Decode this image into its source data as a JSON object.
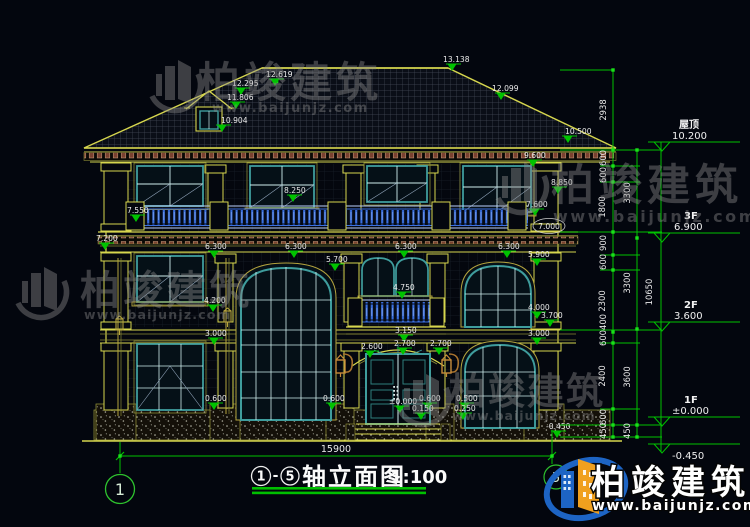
{
  "title": {
    "axis_from": "1",
    "sep": "-",
    "axis_to": "5",
    "name": "轴立面图",
    "scale": "1:100"
  },
  "bottom": {
    "width": "15900",
    "axis_left": "1",
    "axis_right": "5"
  },
  "levels": {
    "roof_label": "屋顶",
    "roof_value": "10.200",
    "f3_label": "3F",
    "f3_value": "6.900",
    "f2_label": "2F",
    "f2_value": "3.600",
    "f1_label": "1F",
    "f1_value": "±0.000",
    "ground_value": "-0.450"
  },
  "chains": {
    "inner": [
      "2938",
      "600",
      "600",
      "1800",
      "900",
      "600",
      "2300",
      "400",
      "600",
      "2400",
      "600",
      "450"
    ],
    "mid": [
      "3300",
      "3300",
      "3600",
      "450"
    ],
    "total": "10650"
  },
  "dims": {
    "roof_ridge": "13.138",
    "roof_right": "12.099",
    "roof_hip": "12.619",
    "dormer_peak": "12.295",
    "dormer_eave": "11.806",
    "dormer_sill": "10.904",
    "eave_top": "10.500",
    "eave_bottom": "9.600",
    "head_3f": "8.850",
    "sill_3f": "8.250",
    "sill_3f_r": "7.600",
    "rail_top": "7.550",
    "rail_bottom": "7.200",
    "level_mid": "7.000",
    "cornice_a": "6.300",
    "cornice_b": "6.300",
    "cornice_c": "6.300",
    "cornice_d": "6.300",
    "arch_top": "5.700",
    "arch_top_r": "5.900",
    "balcony_sill": "4.750",
    "sill_2f_l": "4.200",
    "sill_2f_r": "4.000",
    "band_r": "3.700",
    "balcony_slab": "3.150",
    "floor_l": "3.000",
    "floor_r": "3.000",
    "door_arch_l": "2.600",
    "door_arch_m": "2.700",
    "door_arch_r": "2.700",
    "sill_1f_l": "0.600",
    "sill_1f_m": "0.600",
    "sill_1f_e": "0.600",
    "sill_1f_r": "0.500",
    "step_a": "0.150",
    "step_b": "0.250",
    "door_zero": "±0.000",
    "grade": "-0.450"
  },
  "watermark": {
    "brand": "柏竣建筑",
    "url": "www.baijunjz.com"
  },
  "logo": {
    "brand": "柏竣建筑",
    "url": "www.baijunjz.com"
  },
  "colors": {
    "line_yellow": "#d6d64e",
    "dim_green": "#00c300",
    "window_teal": "#3f9d9d",
    "baluster_blue": "#3a6fe0",
    "logo_blue": "#1d64c4",
    "logo_orange": "#f0a01e"
  }
}
